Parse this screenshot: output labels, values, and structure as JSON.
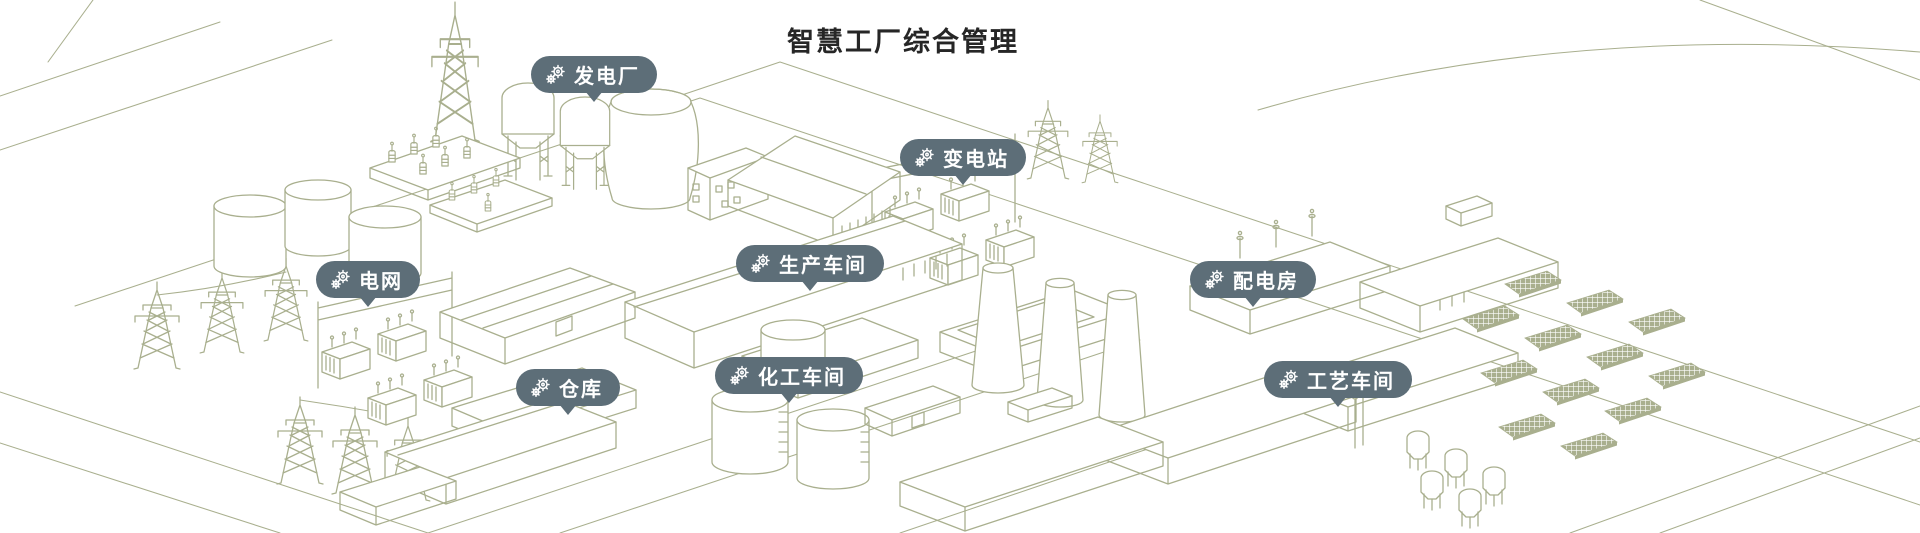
{
  "title": "智慧工厂综合管理",
  "colors": {
    "badge_background": "#5d6e78",
    "badge_text": "#ffffff",
    "illustration_line": "#a9af8e",
    "title_text": "#262626",
    "page_background": "#ffffff"
  },
  "badges": [
    {
      "id": "power-plant",
      "label": "发电厂",
      "icon": "gears-icon"
    },
    {
      "id": "substation",
      "label": "变电站",
      "icon": "gears-icon"
    },
    {
      "id": "power-grid",
      "label": "电网",
      "icon": "gears-icon"
    },
    {
      "id": "production-workshop",
      "label": "生产车间",
      "icon": "gears-icon"
    },
    {
      "id": "distribution-room",
      "label": "配电房",
      "icon": "gears-icon"
    },
    {
      "id": "warehouse",
      "label": "仓库",
      "icon": "gears-icon"
    },
    {
      "id": "chemical-workshop",
      "label": "化工车间",
      "icon": "gears-icon"
    },
    {
      "id": "process-workshop",
      "label": "工艺车间",
      "icon": "gears-icon"
    }
  ],
  "illustration": {
    "style": "isometric-line-art",
    "structures": [
      "transmission-towers",
      "power-plant-cooling-tower",
      "hopper-silos",
      "transformer-platforms",
      "substation-transformers",
      "grid-transformers",
      "storage-tanks",
      "sawtooth-factory",
      "pitched-roof-warehouse",
      "production-hall",
      "chimneys",
      "chemical-tanks",
      "warehouse-buildings",
      "distribution-buildings",
      "solar-panel-array",
      "process-vessels",
      "roads"
    ]
  }
}
